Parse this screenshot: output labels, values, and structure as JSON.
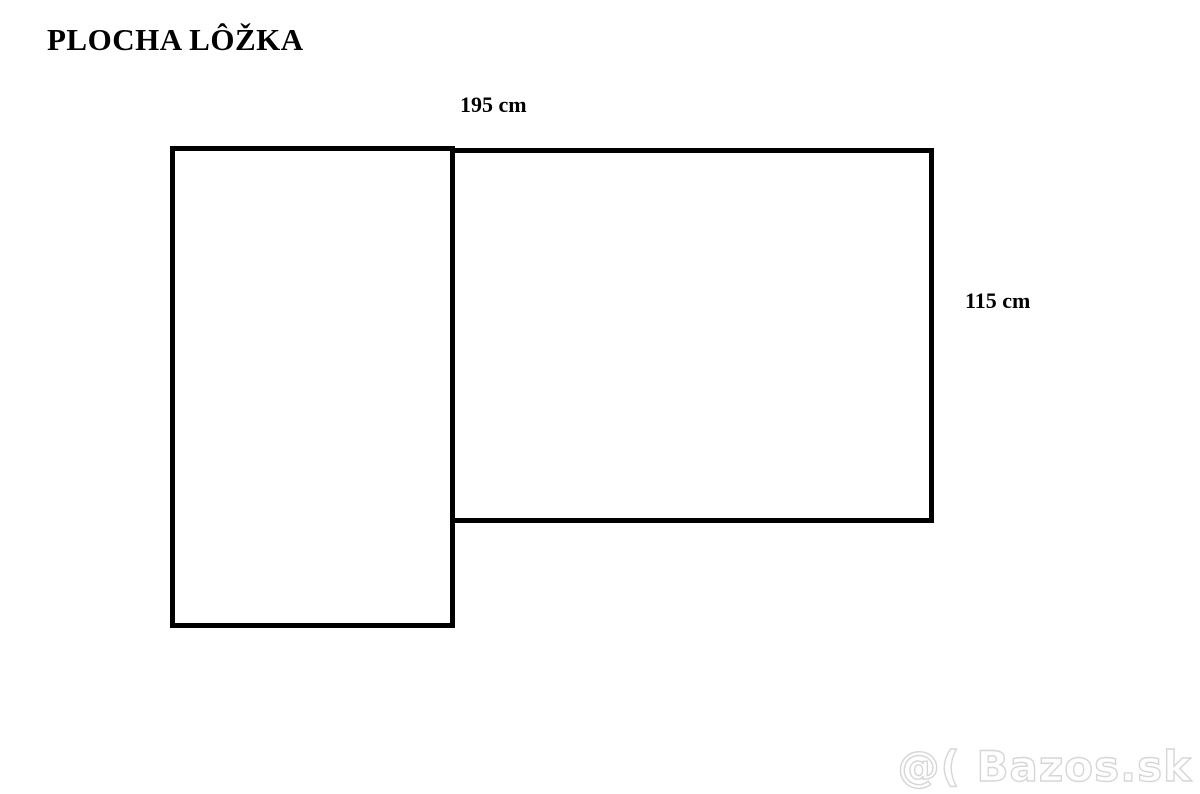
{
  "title": "PLOCHA LÔŽKA",
  "diagram": {
    "description": "bed-area-outline-two-rectangles",
    "width_label": "195 cm",
    "height_label": "115 cm"
  },
  "watermark": "@( Bazos.sk",
  "colors": {
    "background": "#ffffff",
    "line": "#000000",
    "text": "#000000",
    "watermark_outline": "#d6d6d6"
  }
}
